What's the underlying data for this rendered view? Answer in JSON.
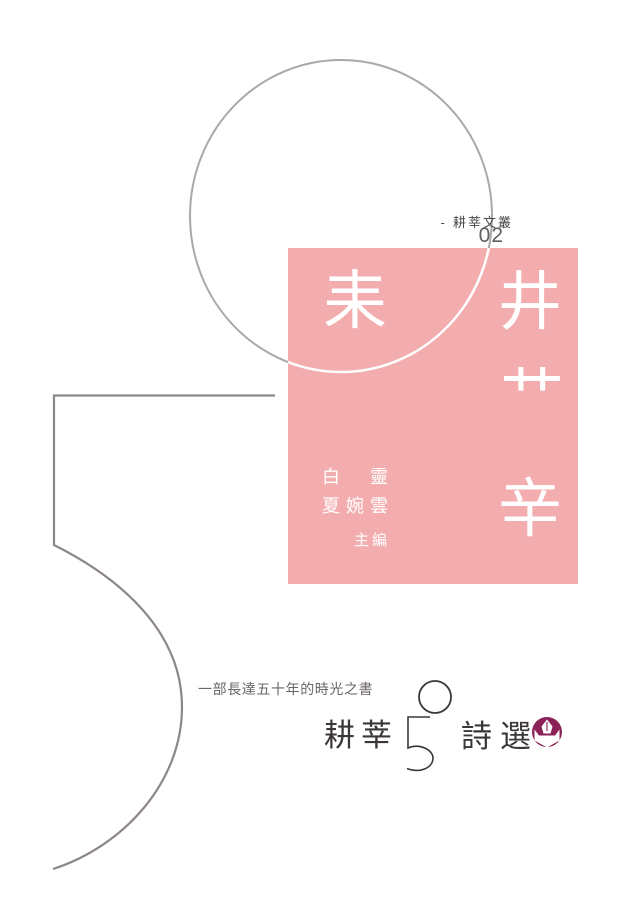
{
  "cover": {
    "series_label": "- 耕莘文叢",
    "series_number": "02",
    "deco_chars": {
      "lei": "耒",
      "jing": "井",
      "cao": "艹",
      "xin": "辛"
    },
    "editors": {
      "line1": "白　靈",
      "line2": "夏婉雲",
      "role": "主編"
    },
    "tagline": "一部長達五十年的時光之書",
    "title": {
      "part1": "耕莘",
      "number": "50",
      "part2": "詩選"
    },
    "logo": "pen-nib-emblem"
  },
  "colors": {
    "pink": "#f3adaf",
    "circle_gray": "#a9a9a9",
    "line_gray": "#8e8789",
    "ink": "#3b3738",
    "white": "#ffffff",
    "logo_maroon": "#8b2257"
  }
}
